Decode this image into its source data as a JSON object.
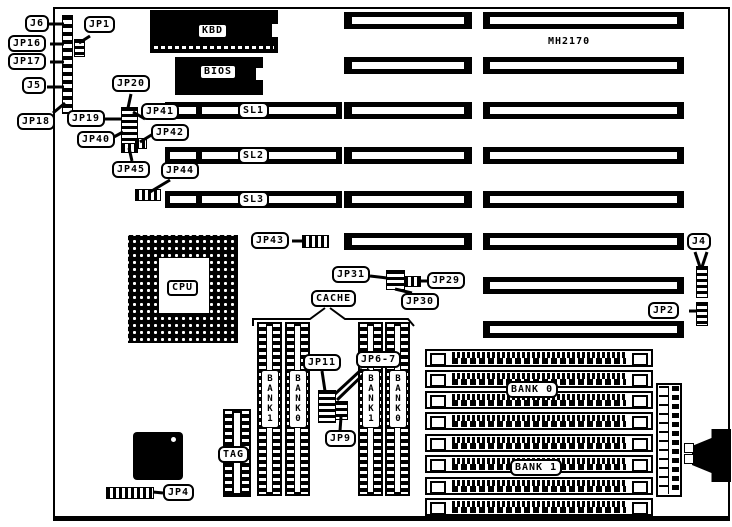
{
  "board": {
    "model": "MH2170",
    "ink_color": "#000000",
    "paper_color": "#ffffff"
  },
  "chips": {
    "kbd": "KBD",
    "bios": "BIOS",
    "cpu": "CPU",
    "tag": "TAG",
    "cache": "CACHE"
  },
  "slots": {
    "sl1": "SL1",
    "sl2": "SL2",
    "sl3": "SL3"
  },
  "memory": {
    "simm_bank0": "BANK 0",
    "simm_bank1": "BANK 1",
    "cache_banks": [
      "BANK1",
      "BANK0",
      "BANK1",
      "BANK0"
    ]
  },
  "connectors": {
    "j4": "J4",
    "j5": "J5",
    "j6": "J6"
  },
  "jumpers": {
    "jp1": "JP1",
    "jp2": "JP2",
    "jp4": "JP4",
    "jp9": "JP9",
    "jp11": "JP11",
    "jp67": "JP6-7",
    "jp16": "JP16",
    "jp17": "JP17",
    "jp18": "JP18",
    "jp19": "JP19",
    "jp20": "JP20",
    "jp29": "JP29",
    "jp30": "JP30",
    "jp31": "JP31",
    "jp40": "JP40",
    "jp41": "JP41",
    "jp42": "JP42",
    "jp43": "JP43",
    "jp44": "JP44",
    "jp45": "JP45"
  }
}
